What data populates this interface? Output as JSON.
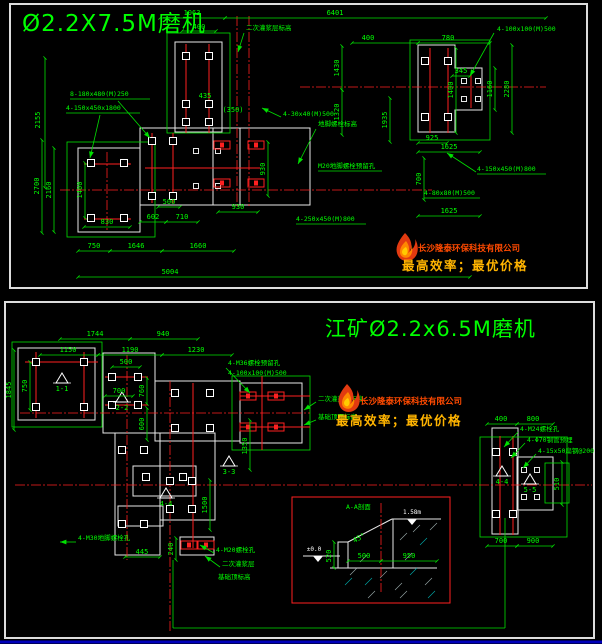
{
  "colors": {
    "background": "#000000",
    "text_green": "#00ff00",
    "line_green": "#00e000",
    "line_red": "#ff2020",
    "line_white": "#e8e8e8",
    "panel_border": "#dddddd",
    "bottom_rule_blue": "#0000bb",
    "detail_box_red": "#ff2020",
    "logo_flame_red": "#e23a10",
    "logo_flame_orange": "#ff8800",
    "logo_text_color": "#ff4a00",
    "logo_slogan_color": "#ffb400"
  },
  "logo": {
    "company": "长沙隆泰环保科技有限公司",
    "slogan": "最高效率；最优价格",
    "flame_icon": "flame-icon"
  },
  "top": {
    "title": "Ø2.2X7.5M磨机",
    "dims": [
      "1063",
      "6401",
      "400",
      "400",
      "780",
      "4-100x100(M)500",
      "2155",
      "1430",
      "1320",
      "435",
      "(350)",
      "345",
      "1400",
      "1160",
      "2280",
      "8-180x480(M)250",
      "4-150x450x1800",
      "2700",
      "2160",
      "1400",
      "830",
      "500",
      "602",
      "710",
      "930",
      "930",
      "750",
      "1646",
      "1660",
      "5004",
      "925",
      "1625",
      "700",
      "4-150x450(M)800",
      "4-80x80(M)500",
      "1625",
      "4-250x450(M)800",
      "M20地脚螺栓预留孔",
      "二次灌浆层标高",
      "地脚螺栓标高",
      "1935",
      "4-30x40(M)500"
    ]
  },
  "bottom": {
    "title": "江矿Ø2.2x6.5M磨机",
    "dims": [
      "1744",
      "940",
      "1150",
      "1190",
      "1230",
      "1845",
      "750",
      "500",
      "760",
      "600",
      "700",
      "4-M36螺栓预留孔",
      "4-100x100(M)500",
      "4-M30地脚螺栓孔",
      "4-M20螺栓孔",
      "二次灌浆层",
      "基础顶标高",
      "400",
      "800",
      "700",
      "900",
      "510",
      "4-M24螺栓孔",
      "4-Φ70钢管预埋",
      "4-15x50扁钢@200",
      "445",
      "240",
      "1350",
      "1500",
      "二次灌浆层标高",
      "基础顶面标高"
    ],
    "sections": [
      "1-1",
      "2-2",
      "3-3",
      "4-4",
      "5-5"
    ],
    "detail": {
      "label": "A-A剖面",
      "elev_top": "1.58m",
      "elev_zero": "±0.0",
      "height": "520",
      "width_left": "500",
      "width_right": "950",
      "slope": "45°"
    }
  }
}
